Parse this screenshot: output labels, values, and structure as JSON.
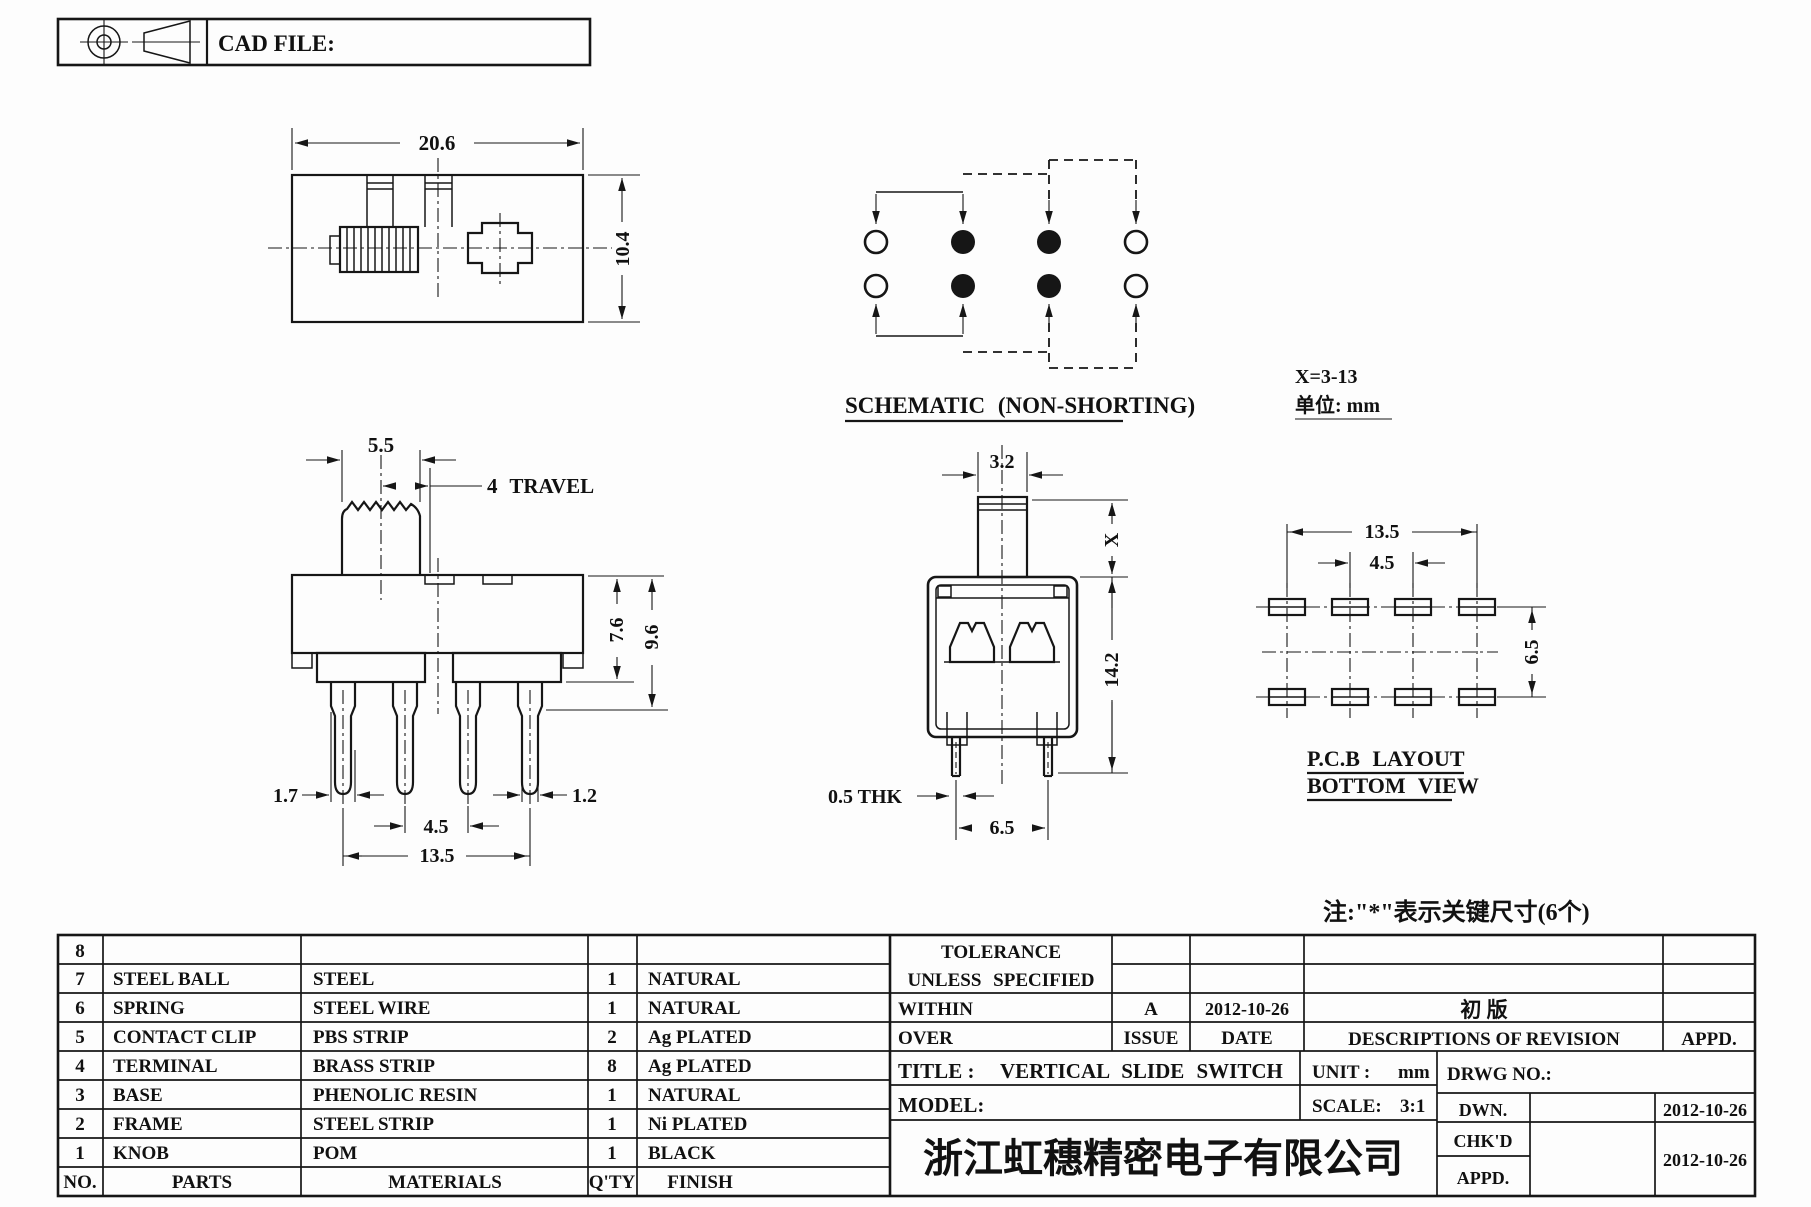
{
  "header": {
    "cad_file_label": "CAD FILE:"
  },
  "drawing": {
    "top_view": {
      "width": "20.6",
      "height": "10.4"
    },
    "front_view": {
      "knob_width": "5.5",
      "travel": "4 TRAVEL",
      "body_height": "7.6",
      "overall_height": "9.6",
      "pin_width_left": "1.7",
      "pin_width_right": "1.2",
      "pin_pitch": "4.5",
      "pin_span": "13.5"
    },
    "side_view": {
      "knob_width": "3.2",
      "knob_height": "X",
      "body_height": "14.2",
      "terminal_thickness": "0.5 THK",
      "pin_spacing": "6.5"
    },
    "schematic": {
      "title": "SCHEMATIC (NON-SHORTING)",
      "x_range": "X=3-13",
      "unit": "单位: mm"
    },
    "pcb": {
      "title1": "P.C.B LAYOUT",
      "title2": "BOTTOM VIEW",
      "span": "13.5",
      "pitch": "4.5",
      "row_spacing": "6.5"
    },
    "note": "注:\"*\"表示关键尺寸(6个)"
  },
  "parts_table": {
    "headers": {
      "no": "NO.",
      "parts": "PARTS",
      "materials": "MATERIALS",
      "qty": "Q'TY",
      "finish": "FINISH"
    },
    "rows": [
      {
        "no": "8",
        "parts": "",
        "materials": "",
        "qty": "",
        "finish": ""
      },
      {
        "no": "7",
        "parts": "STEEL BALL",
        "materials": "STEEL",
        "qty": "1",
        "finish": "NATURAL"
      },
      {
        "no": "6",
        "parts": "SPRING",
        "materials": "STEEL WIRE",
        "qty": "1",
        "finish": "NATURAL"
      },
      {
        "no": "5",
        "parts": "CONTACT CLIP",
        "materials": "PBS STRIP",
        "qty": "2",
        "finish": "Ag PLATED"
      },
      {
        "no": "4",
        "parts": "TERMINAL",
        "materials": "BRASS STRIP",
        "qty": "8",
        "finish": "Ag PLATED"
      },
      {
        "no": "3",
        "parts": "BASE",
        "materials": "PHENOLIC RESIN",
        "qty": "1",
        "finish": "NATURAL"
      },
      {
        "no": "2",
        "parts": "FRAME",
        "materials": "STEEL STRIP",
        "qty": "1",
        "finish": "Ni PLATED"
      },
      {
        "no": "1",
        "parts": "KNOB",
        "materials": "POM",
        "qty": "1",
        "finish": "BLACK"
      }
    ]
  },
  "title_block": {
    "tolerance_line1": "TOLERANCE",
    "tolerance_line2": "UNLESS SPECIFIED",
    "within": "WITHIN",
    "over": "OVER",
    "issue_value": "A",
    "issue_date": "2012-10-26",
    "issue_label": "ISSUE",
    "date_label": "DATE",
    "revision_description": "初  版",
    "revision_header": "DESCRIPTIONS OF REVISION",
    "revision_appd": "APPD.",
    "title_label": "TITLE :",
    "title_value": "VERTICAL SLIDE SWITCH",
    "unit_label": "UNIT :",
    "unit_value": "mm",
    "drwg_no_label": "DRWG NO.:",
    "model_label": "MODEL:",
    "scale_label": "SCALE:",
    "scale_value": "3:1",
    "dwn_label": "DWN.",
    "dwn_date": "2012-10-26",
    "chkd_label": "CHK'D",
    "chkd_date": "2012-10-26",
    "appd_label": "APPD.",
    "company": "浙江虹穗精密电子有限公司"
  }
}
